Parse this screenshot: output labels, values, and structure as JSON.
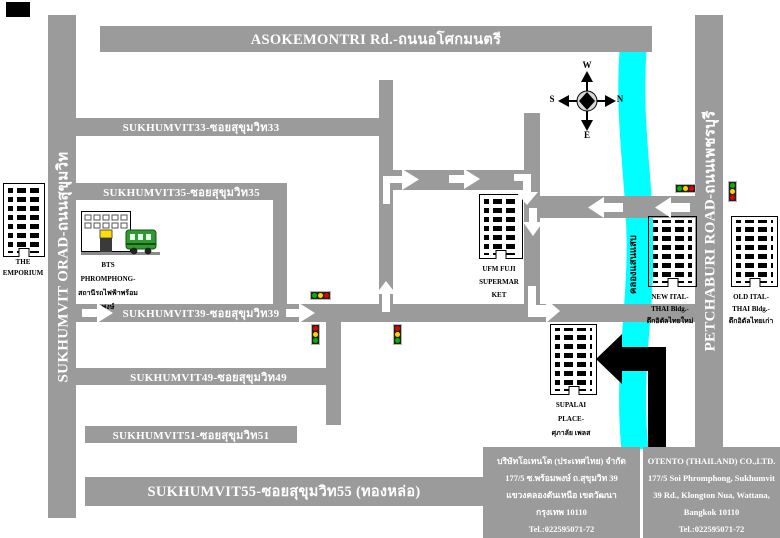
{
  "roads": {
    "asokemontri": "ASOKEMONTRI Rd.-ถนนอโศกมนตรี",
    "sukhumvit_left": "SUKHUMVIT ORAD-ถนนสุขุมวิท",
    "petchaburi": "PETCHABURI ROAD-ถนนเพชรบุรี",
    "soi33": "SUKHUMVIT33-ซอยสุขุมวิท33",
    "soi35": "SUKHUMVIT35-ซอยสุขุมวิท35",
    "soi39": "SUKHUMVIT39-ซอยสุขุมวิท39",
    "soi49": "SUKHUMVIT49-ซอยสุขุมวิท49",
    "soi51": "SUKHUMVIT51-ซอยสุขุมวิท51",
    "soi55": "SUKHUMVIT55-ซอยสุขุมวิท55 (ทองหล่อ)"
  },
  "canal": {
    "label": "คลองแสนแสบ",
    "color": "#00ffff"
  },
  "compass": {
    "w": "W",
    "e": "E",
    "n": "N",
    "s": "S"
  },
  "buildings": {
    "emporium": {
      "lines": [
        "THE",
        "EMPORIUM"
      ]
    },
    "bts": {
      "lines": [
        "BTS",
        "PHROMPHONG-",
        "สถานีรถไฟฟ้าพร้อม",
        "พงษ์"
      ]
    },
    "ufm": {
      "lines": [
        "UFM FUJI",
        "SUPERMAR",
        "KET"
      ]
    },
    "supalai": {
      "lines": [
        "SUPALAI",
        "PLACE-",
        "ศุภาลัย เพลส"
      ]
    },
    "new_ital": {
      "lines": [
        "NEW ITAL-",
        "THAI Bldg.-",
        "ตึกอิตัลไทยใหม่"
      ]
    },
    "old_ital": {
      "lines": [
        "OLD ITAL-",
        "THAI Bldg.-",
        "ตึกอิตัลไทยเก่า"
      ]
    }
  },
  "info": {
    "thai": {
      "lines": [
        "บริษัทโอเทนโต (ประเทศไทย) จำกัด",
        "177/5 ซ.พร้อมพงษ์ ถ.สุขุมวิท 39",
        "แขวงคลองตันเหนือ เขตวัฒนา",
        "กรุงเทพ 10110",
        "Tel.:022595071-72"
      ]
    },
    "english": {
      "lines": [
        "OTENTO (THAILAND) CO.,LTD.",
        "177/5 Soi Phromphong, Sukhumvit",
        "39 Rd., Klongton Nua, Wattana,",
        "Bangkok 10110",
        "Tel.:022595071-72"
      ]
    }
  },
  "colors": {
    "road": "#9b9b9b",
    "canal": "#00ffff"
  }
}
